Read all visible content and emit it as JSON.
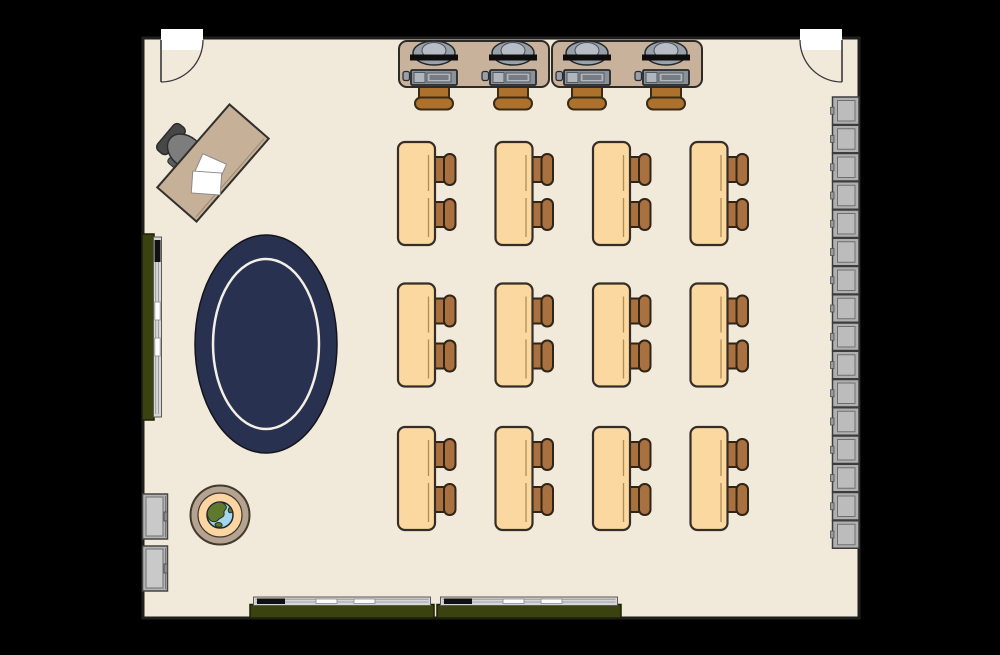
{
  "canvas": {
    "w": 1000,
    "h": 655,
    "bg": "#000000"
  },
  "room": {
    "x": 143,
    "y": 38,
    "w": 716,
    "h": 580,
    "floor": "#f1e9da",
    "wall": "#1f1f1f",
    "wall_w": 3
  },
  "doors": {
    "fill": "#ffffff",
    "stroke": "#3a3a3a",
    "width": 42,
    "depth": 21,
    "radius": 42,
    "items": [
      {
        "name": "door-top-left",
        "x": 161,
        "y": 40,
        "hinge": "left"
      },
      {
        "name": "door-top-right",
        "x": 800,
        "y": 40,
        "hinge": "right"
      }
    ]
  },
  "computer_area": {
    "desk": {
      "w": 150,
      "h": 46,
      "y": 41,
      "rx": 8,
      "fill": "#c8b29b",
      "stroke": "#2e2a26"
    },
    "desk_x": [
      399,
      552
    ],
    "station_dx": [
      35,
      114
    ],
    "monitor": {
      "outer_fill": "#98a0a9",
      "inner_fill": "#b6bdc5",
      "bar_fill": "#0d0d0d",
      "stroke": "#23272b"
    },
    "keyboard": {
      "frame": "#8b9198",
      "keys": "#b0b6bd",
      "inner": "#777c82",
      "stroke": "#26292d"
    },
    "mouse_fill": "#9aa0a8",
    "chair": {
      "fill": "#ad712e",
      "stroke": "#3a2c14"
    }
  },
  "teacher": {
    "desk": {
      "cx": 213,
      "cy": 163,
      "w": 110,
      "h": 52,
      "angle": -49,
      "fill": "#c6b098",
      "stroke": "#32302c",
      "edge_line": "#9b8a74"
    },
    "papers": [
      {
        "x": 197,
        "y": 158,
        "w": 26,
        "h": 23,
        "angle": 24
      },
      {
        "x": 192,
        "y": 172,
        "w": 29,
        "h": 22,
        "angle": 4
      }
    ],
    "paper_fill": "#ffffff",
    "paper_stroke": "#8a8a8a",
    "chair": {
      "cx": 184,
      "cy": 150,
      "angle": -50,
      "seat": "#7d7d7d",
      "back": "#474747",
      "arm": "#5c5c5c",
      "stroke": "#2c2c2c"
    }
  },
  "rug": {
    "cx": 266,
    "cy": 344,
    "rx": 71,
    "ry": 109,
    "fill": "#28314f",
    "stroke": "#14141c",
    "ring_rx": 53,
    "ring_ry": 85,
    "ring_color": "#f4f0e6"
  },
  "reading_table": {
    "cx": 220,
    "cy": 515,
    "r_outer": 29.5,
    "r_inner": 22,
    "r_globe": 13,
    "outer_fill": "#b4a390",
    "inner_fill": "#fbd6a3",
    "stroke": "#42392c",
    "globe_water": "#a6d6ef",
    "globe_land": "#5f7a2e",
    "land_paths": [
      "M 211 504 C 216 500 224 502 226 506 C 228 509 223 510 224 513 C 225 517 221 517 218 520 C 215 523 210 522 208 517 C 206 512 208 507 211 504 Z",
      "M 229 508 C 232 507 234 510 232 512 C 230 514 227 512 229 508 Z",
      "M 215 524 C 218 521 223 523 222 526 C 219 528 215 527 215 524 Z"
    ]
  },
  "boards": {
    "green": "#3a420f",
    "green_stroke": "#1c2008",
    "tray_fill": "#d6d6d6",
    "tray_stroke": "#5a5a5a",
    "tray_line": "#8f8f8f",
    "eraser": "#101010",
    "chalk": "#fdfdfd",
    "chalk_stroke": "#8a8a8a",
    "left": {
      "x": 142,
      "y": 234,
      "w": 12,
      "h": 186,
      "tray_x": 153.5,
      "tray_w": 8,
      "eraser_y": 240,
      "eraser_h": 22,
      "chalk_y": [
        302,
        338
      ],
      "chalk_h": 18
    },
    "bottom": {
      "x": [
        250,
        437
      ],
      "y": 604.5,
      "w": 184,
      "h": 13.5,
      "tray_y": 597,
      "tray_h": 8.5,
      "eraser_dx": 7,
      "eraser_w": 28,
      "chalk_dx": [
        66,
        104
      ],
      "chalk_w": 21
    }
  },
  "cabinets": {
    "x": 142.5,
    "w": 25,
    "h": 45,
    "y": [
      494,
      546
    ],
    "fill": "#b3b3b3",
    "inner": "#c9c9c9",
    "stroke": "#454545",
    "inner_stroke": "#707070",
    "handle": "#8b8b8b"
  },
  "lockers": {
    "x": 832.5,
    "w": 26.5,
    "h": 27.5,
    "y_start": 97,
    "step": 28.25,
    "count": 16,
    "fill": "#b0b0b0",
    "inner": "#bcbcbc",
    "stroke": "#3c3c3c",
    "inner_stroke": "#6e6e6e",
    "latch": "#9a9a9a"
  },
  "student_desks": {
    "cols_x": [
      398,
      495.5,
      593,
      690.5
    ],
    "rows_y": [
      142,
      283.5,
      427
    ],
    "w": 37,
    "h": 103,
    "rx": 7,
    "fill": "#fcd8a1",
    "stroke": "#352e26",
    "leg": "#261d15",
    "edge_line": "#b08d52",
    "chair": {
      "dy": [
        27.5,
        72.5
      ],
      "fill": "#aa7140",
      "stroke": "#2e2418"
    }
  }
}
